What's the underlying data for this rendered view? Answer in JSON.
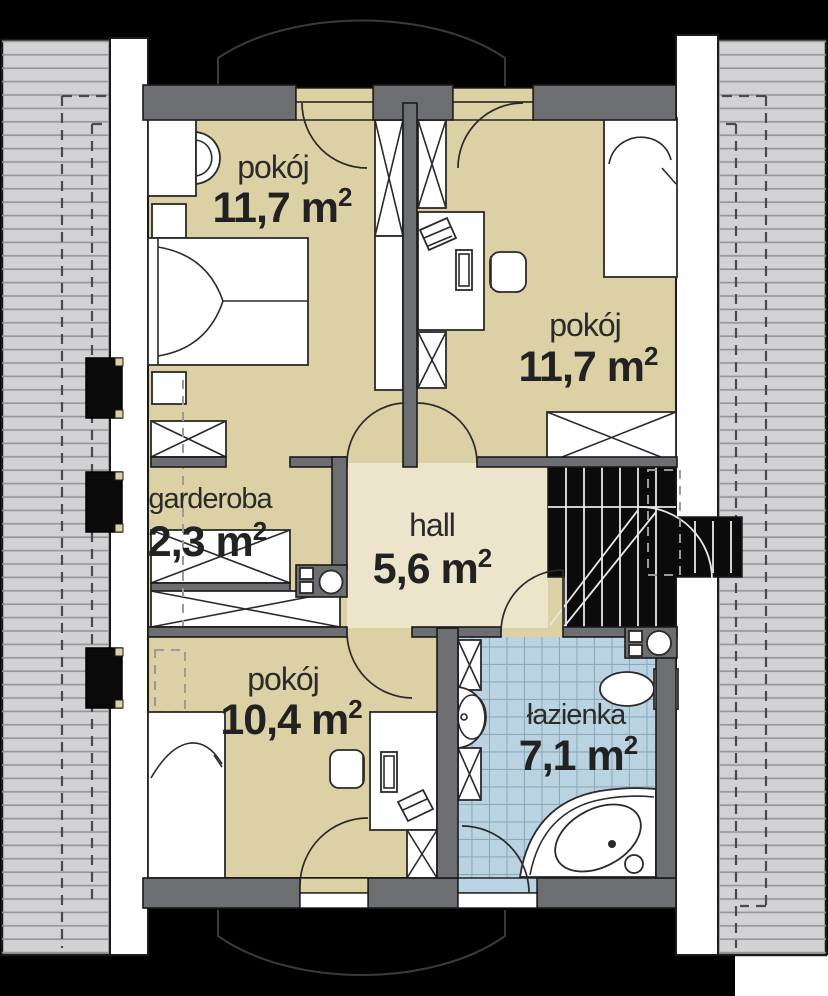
{
  "rooms": [
    {
      "key": "pokoj-top-left",
      "name": "pokój",
      "area": "11,7 m",
      "area_sup": "2"
    },
    {
      "key": "pokoj-right",
      "name": "pokój",
      "area": "11,7 m",
      "area_sup": "2"
    },
    {
      "key": "garderoba",
      "name": "garderoba",
      "area": "2,3 m",
      "area_sup": "2"
    },
    {
      "key": "hall",
      "name": "hall",
      "area": "5,6 m",
      "area_sup": "2"
    },
    {
      "key": "pokoj-bottom",
      "name": "pokój",
      "area": "10,4 m",
      "area_sup": "2"
    },
    {
      "key": "lazienka",
      "name": "łazienka",
      "area": "7,1 m",
      "area_sup": "2"
    }
  ],
  "colors": {
    "bg": "#000000",
    "roof": "#d2d2d4",
    "room": "#dcd1a5",
    "hall": "#ece5cc",
    "bath": "#b9d3e3",
    "wall": "#6d6e71",
    "stair": "#0b0b0b"
  }
}
